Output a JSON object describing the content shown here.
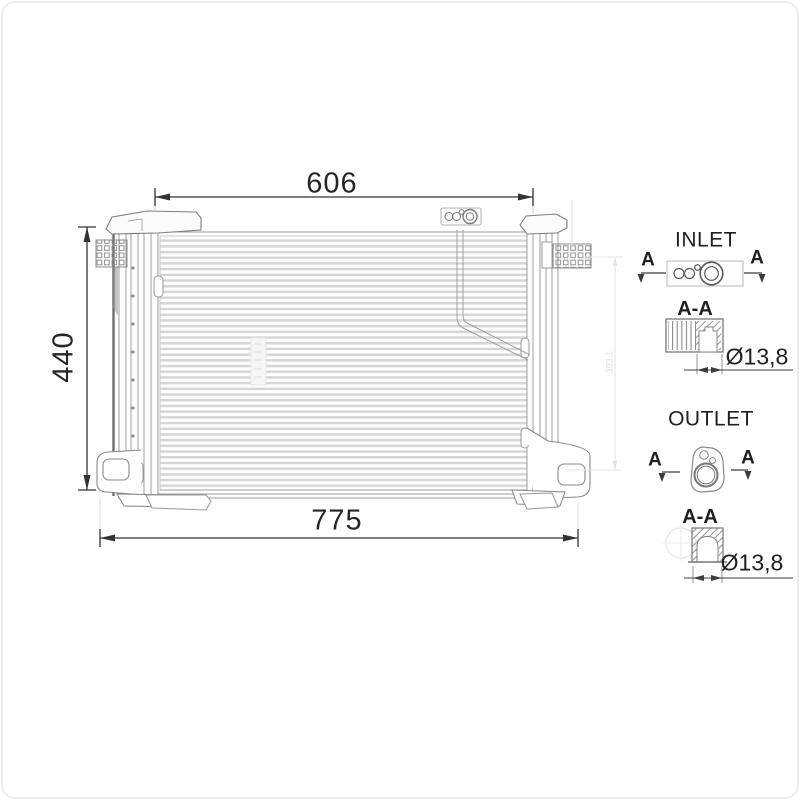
{
  "drawing": {
    "type": "condenser-technical-drawing",
    "line_color": "#8a8a8a",
    "dim_color": "#2a2a2a",
    "faint_color": "#e0e0e0"
  },
  "dims": {
    "core_width": "606",
    "overall_width": "775",
    "height": "440",
    "side_height": "393,1"
  },
  "inlet": {
    "title": "INLET",
    "marker_left": "A",
    "marker_right": "A",
    "section": "A-A",
    "diameter": "Ø13,8"
  },
  "outlet": {
    "title": "OUTLET",
    "marker_left": "A",
    "marker_right": "A",
    "section": "A-A",
    "diameter": "Ø13,8"
  }
}
